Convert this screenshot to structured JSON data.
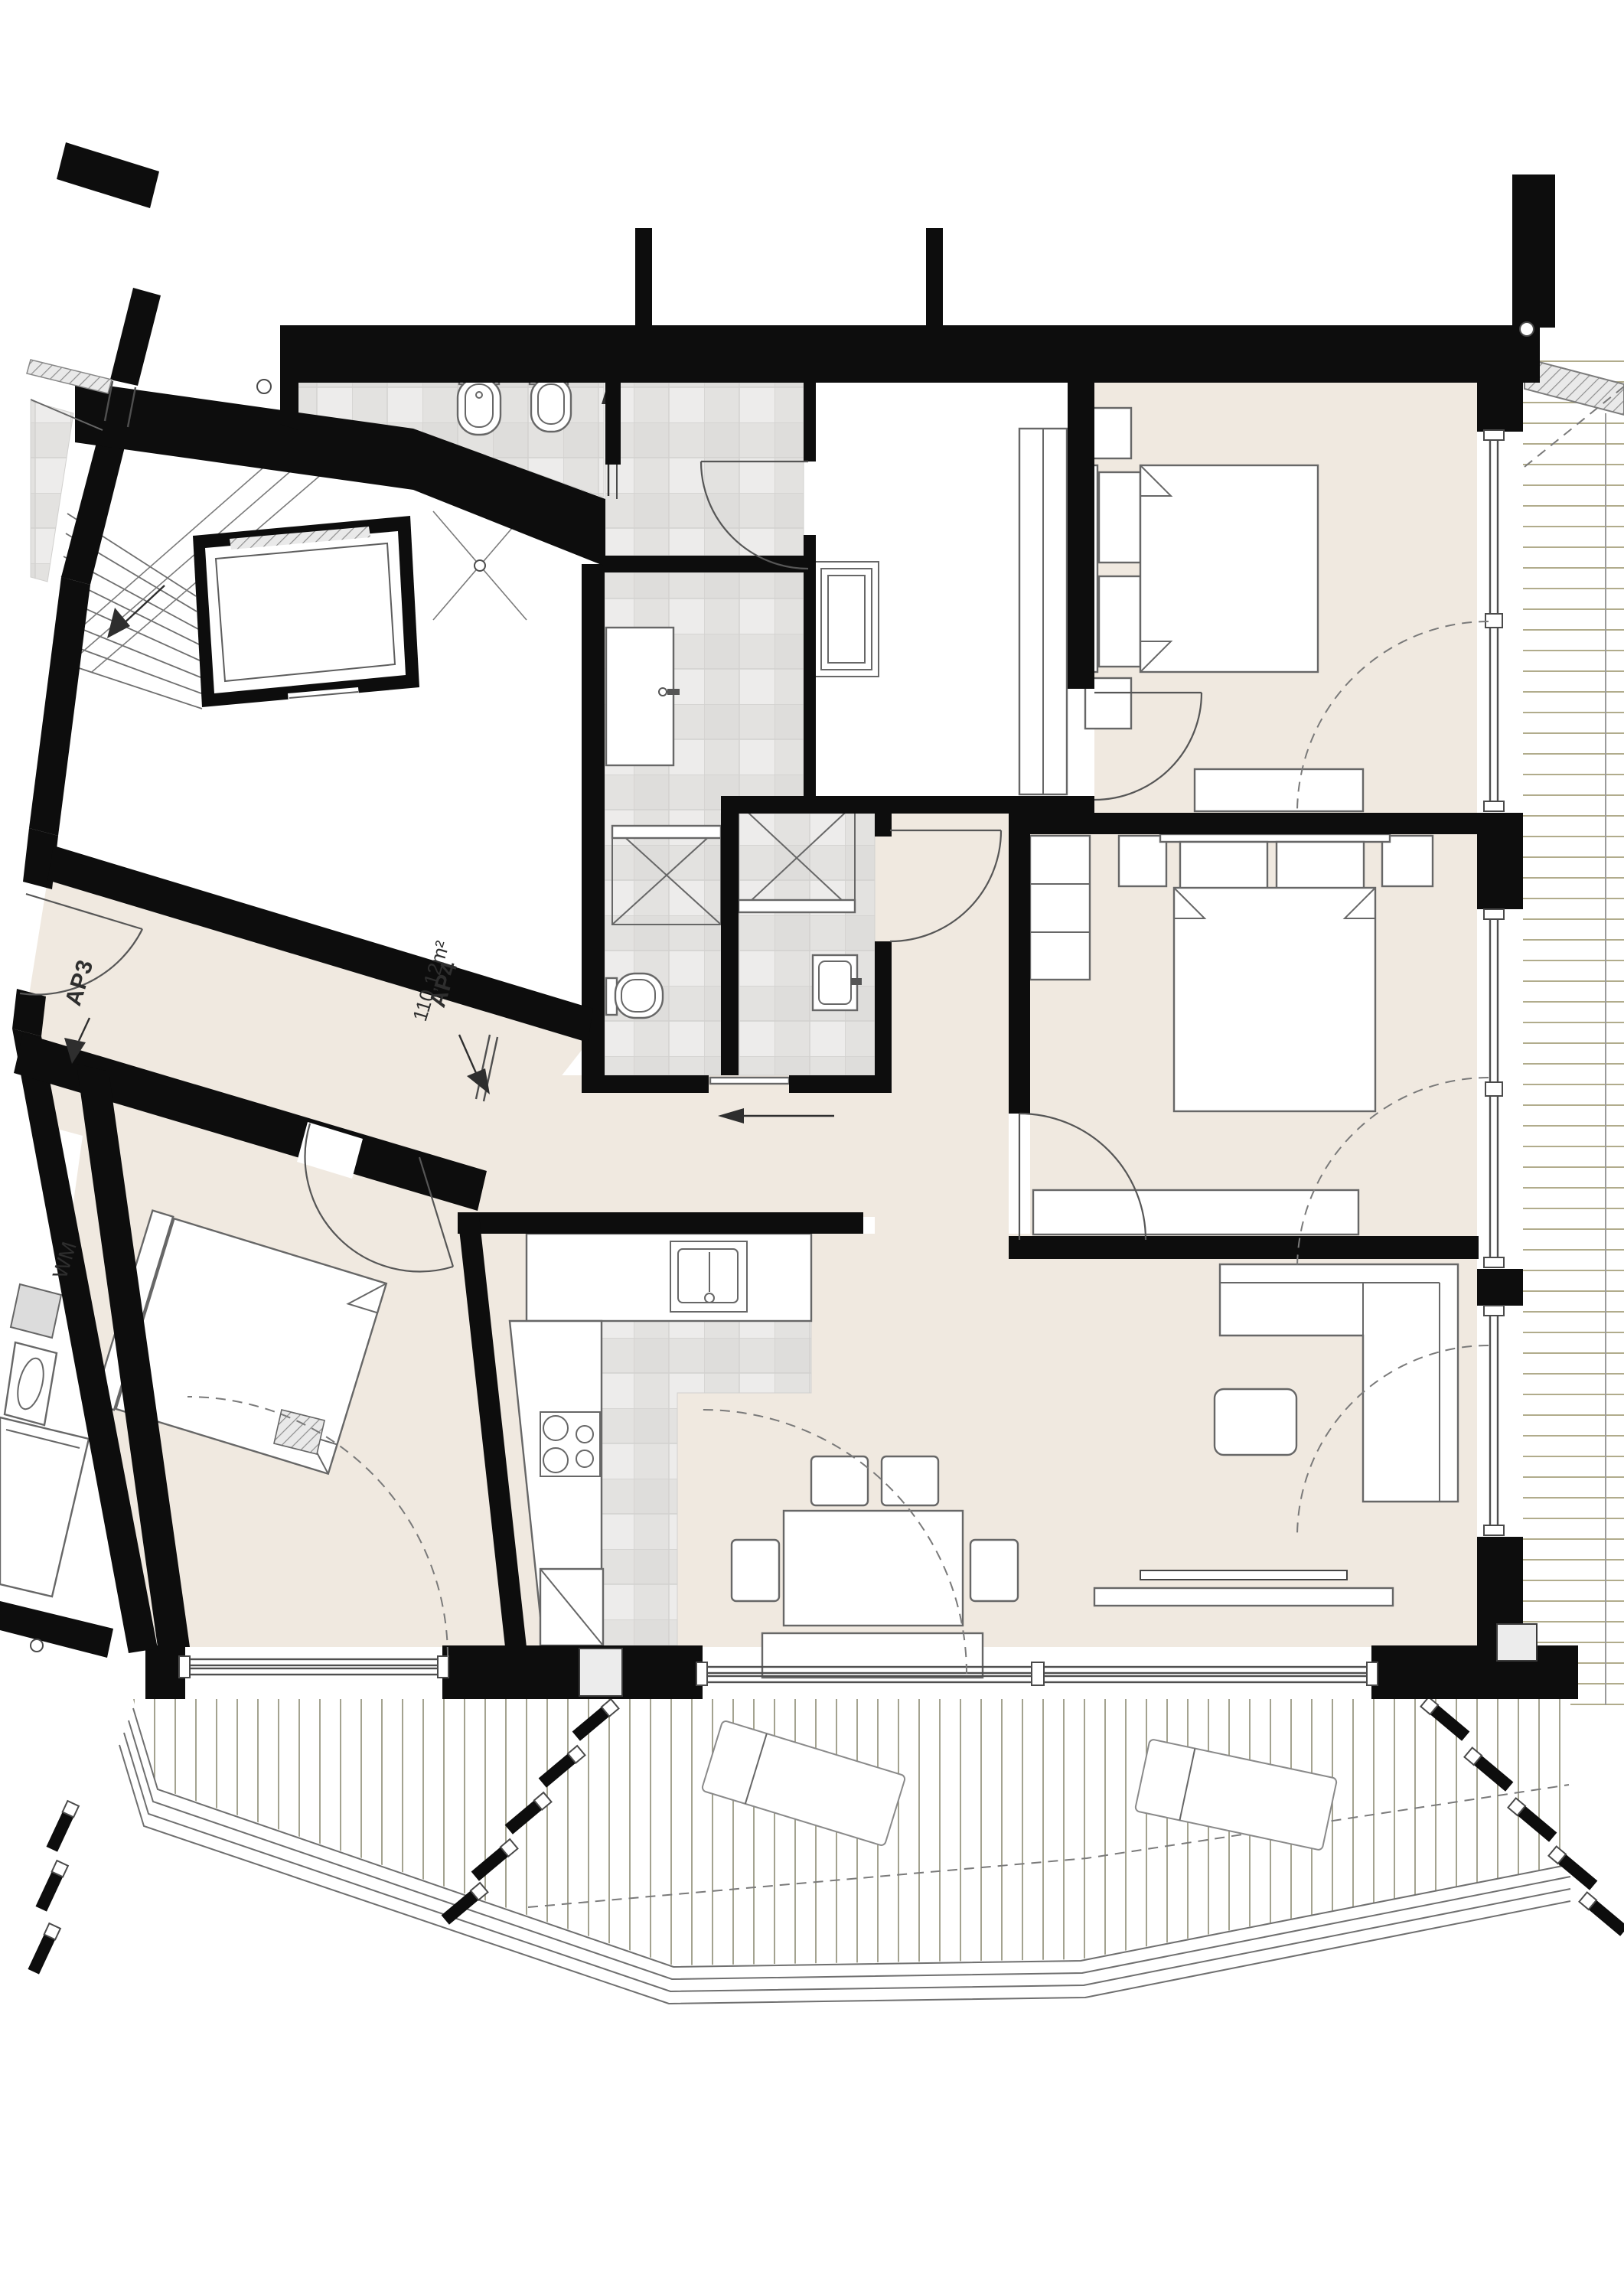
{
  "document": {
    "type": "architectural-floor-plan",
    "view": "apartment plan with stairwell, two balconies and terrace"
  },
  "labels": {
    "ap3": "AP3",
    "ap4": "AP4",
    "ap4_area": "110,12m²",
    "wm": "WM"
  },
  "colors": {
    "wall": "#0d0d0d",
    "floor_wood": "#f0e9e0",
    "floor_tile": "#e3e2e0",
    "tile_grid": "#d2d1cf",
    "deck_line": "#a8a37f",
    "terrace_line": "#8e8c75",
    "furniture_stroke": "#676767",
    "dashed": "#7a7a7a",
    "hatch": "#8f8f8f",
    "label": "#2e2e2e",
    "paper": "#ffffff"
  }
}
